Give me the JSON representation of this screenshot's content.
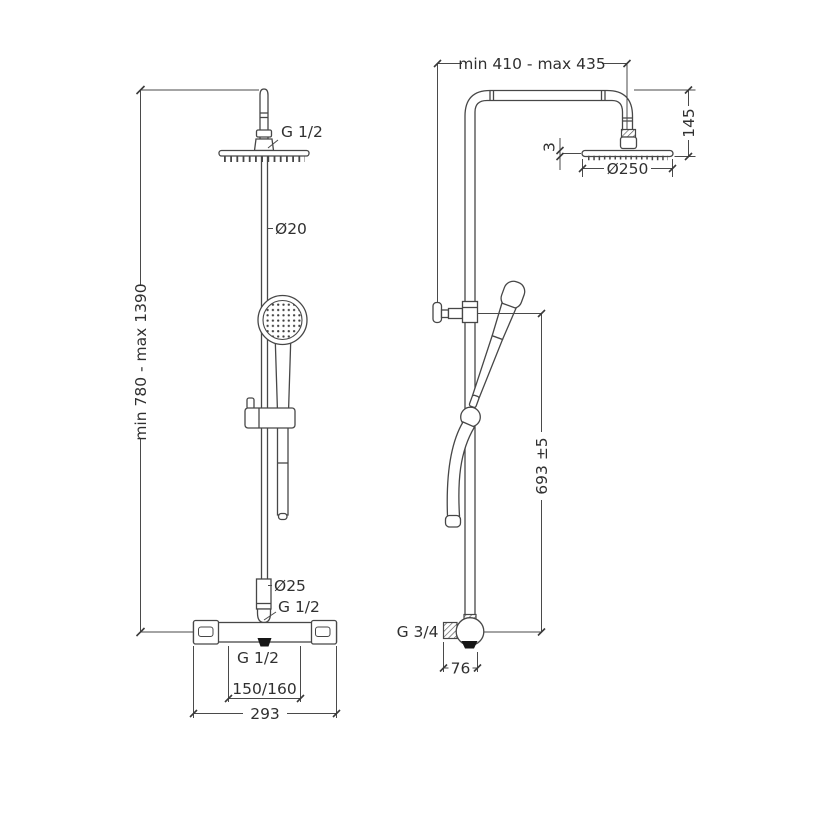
{
  "drawing": {
    "type": "technical-dimension-drawing",
    "subject": "thermostatic shower column, front and side views",
    "background_color": "#ffffff",
    "line_color": "#474747",
    "text_color": "#303030",
    "front_view": {
      "top_connector_label": "G 1/2",
      "riser_diameter_label": "Ø20",
      "height_range_label": "min 780 - max 1390",
      "lower_riser_diameter_label": "Ø25",
      "riser_inlet_label": "G 1/2",
      "valve_outlet_label": "G 1/2",
      "port_spacing_label": "150/160",
      "valve_width_label": "293"
    },
    "side_view": {
      "arm_reach_label": "min 410 - max 435",
      "head_drop_label": "145",
      "head_thickness_label": "3",
      "head_diameter_label": "Ø250",
      "bracket_height_label": "693 ±5",
      "wall_inlet_label": "G 3/4",
      "valve_depth_label": "76"
    }
  }
}
